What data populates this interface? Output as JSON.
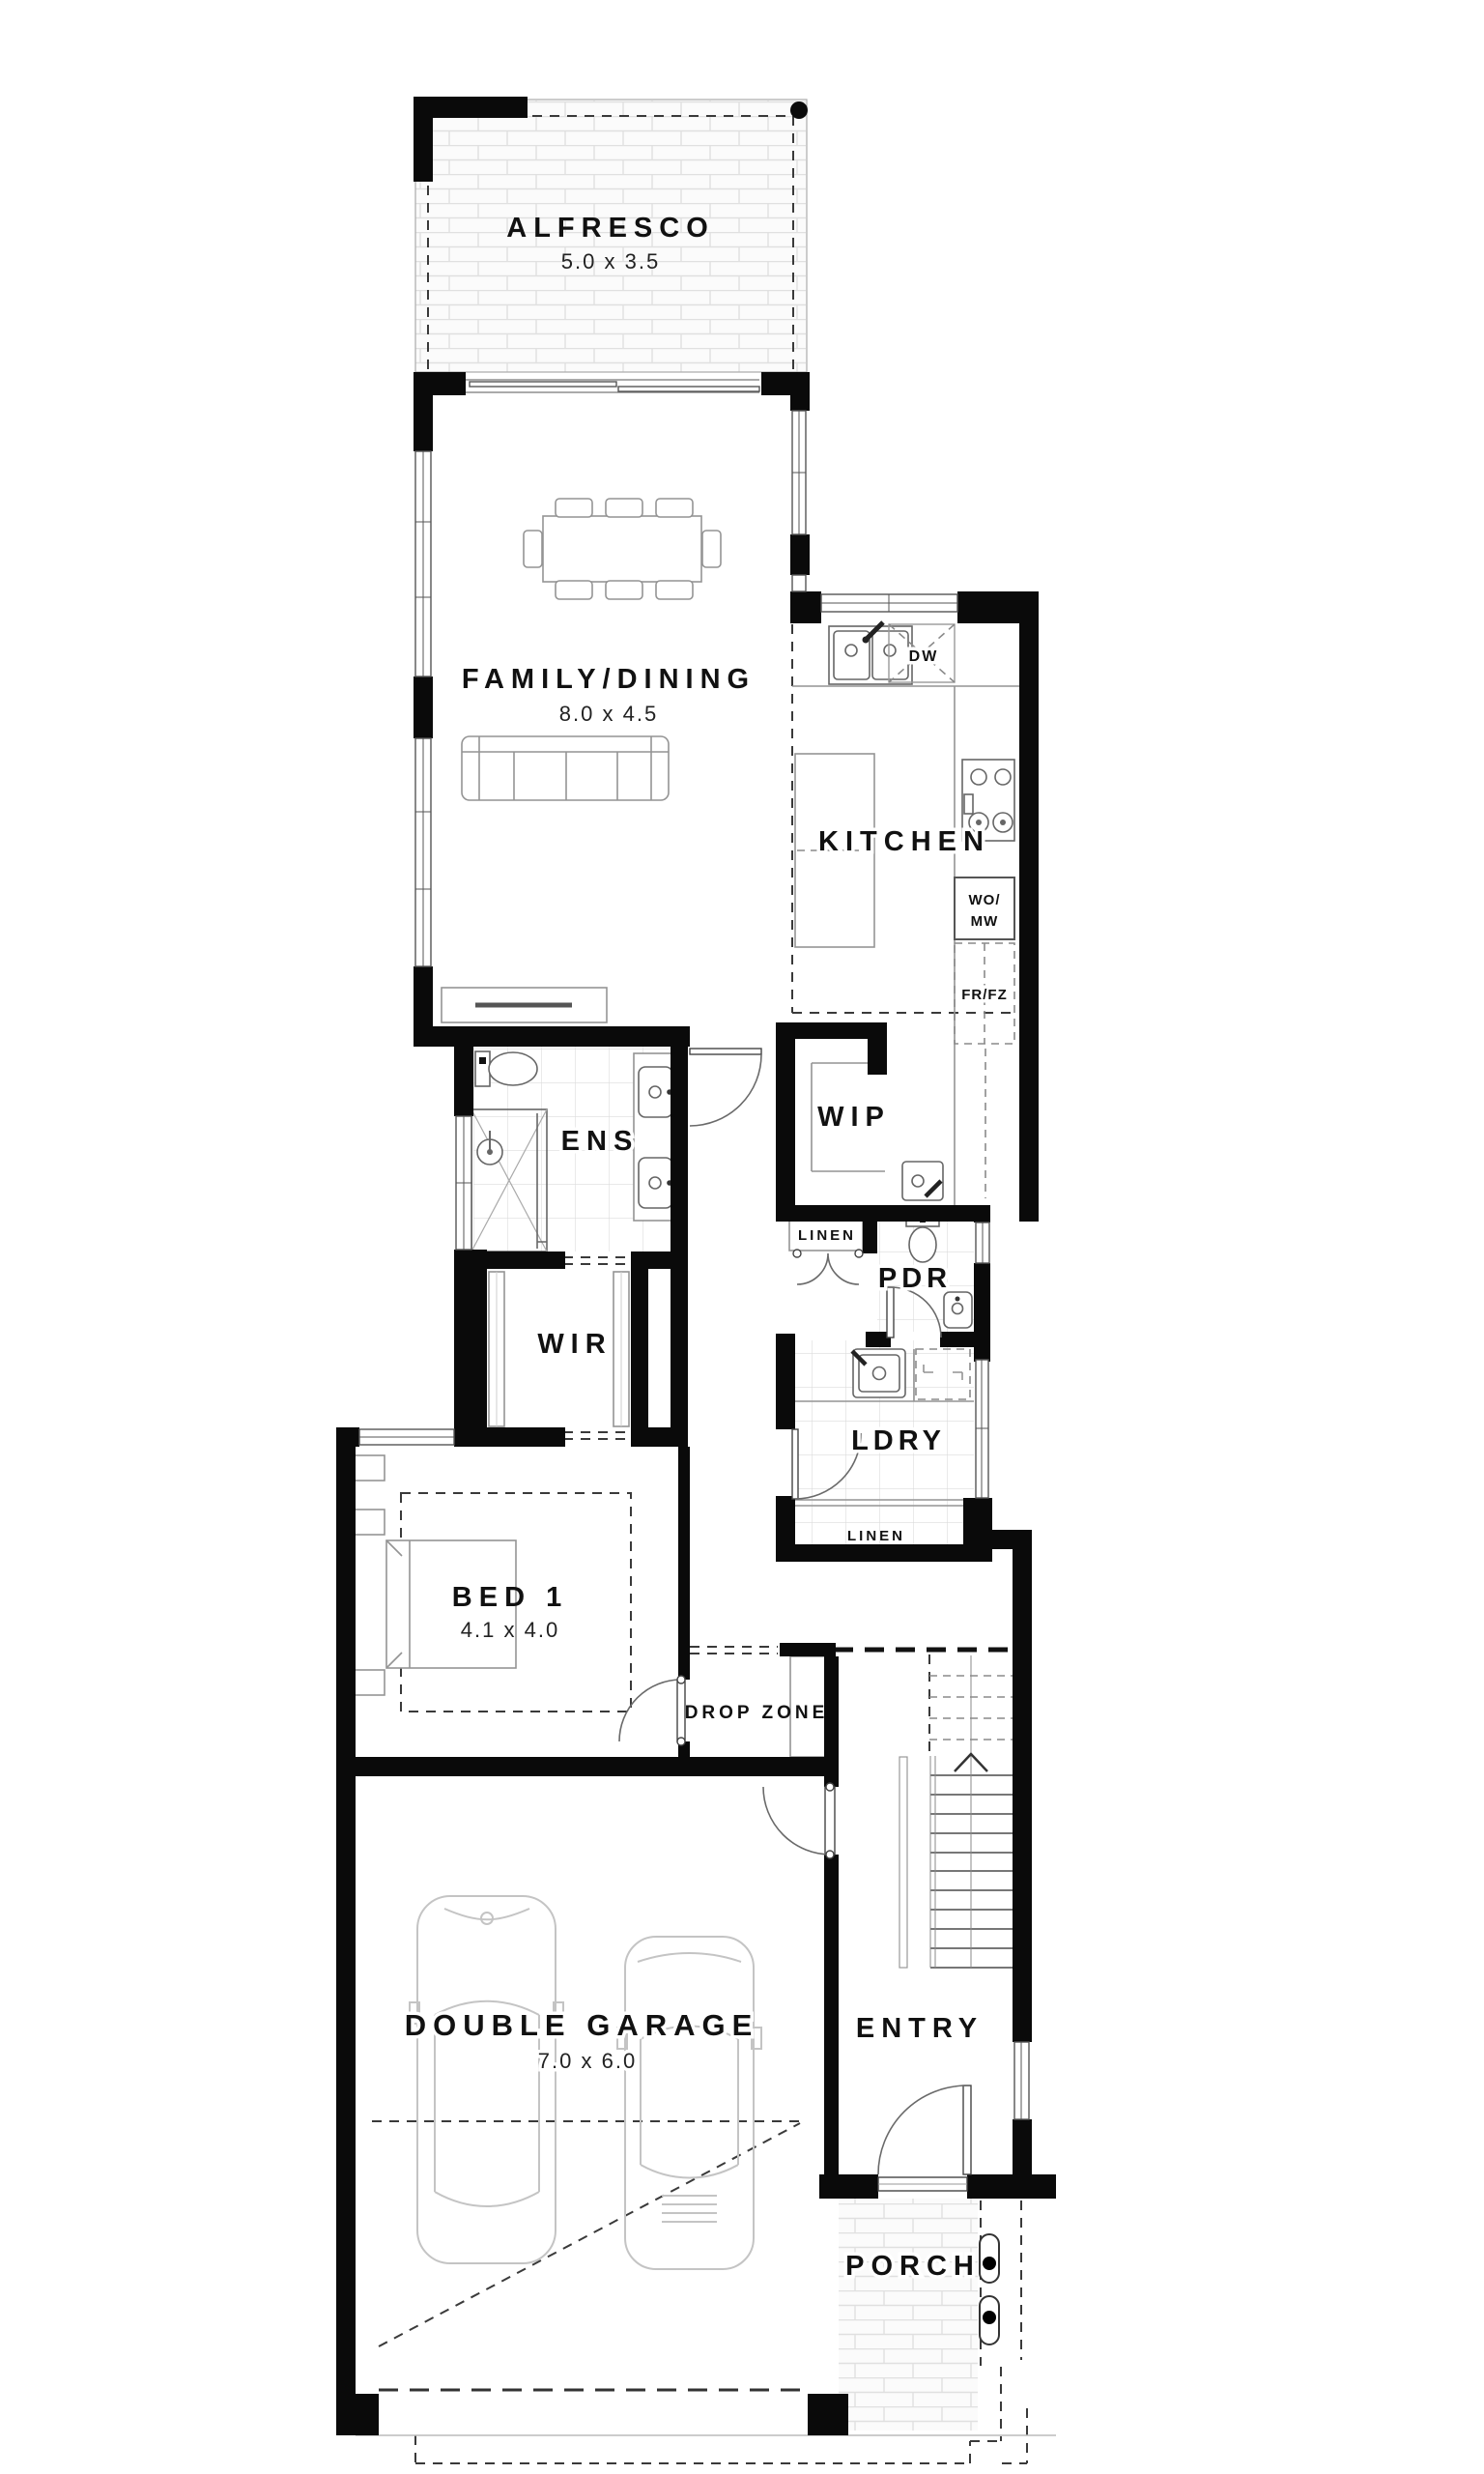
{
  "plan_title": "Single storey home ground floor plan",
  "rooms": {
    "alfresco": {
      "label": "ALFRESCO",
      "dims": "5.0 x 3.5"
    },
    "family_dining": {
      "label": "FAMILY/DINING",
      "dims": "8.0 x 4.5"
    },
    "kitchen": {
      "label": "KITCHEN"
    },
    "wip": {
      "label": "WIP"
    },
    "ens": {
      "label": "ENS"
    },
    "wir": {
      "label": "WIR"
    },
    "linen_upper": {
      "label": "LINEN"
    },
    "pdr": {
      "label": "PDR"
    },
    "ldry": {
      "label": "LDRY"
    },
    "linen_lower": {
      "label": "LINEN"
    },
    "bed1": {
      "label": "BED 1",
      "dims": "4.1 x 4.0"
    },
    "drop_zone": {
      "label": "DROP ZONE"
    },
    "double_garage": {
      "label": "DOUBLE GARAGE",
      "dims": "7.0 x 6.0"
    },
    "entry": {
      "label": "ENTRY"
    },
    "porch": {
      "label": "PORCH"
    }
  },
  "appliances": {
    "dishwasher": "DW",
    "wall_oven_line1": "WO/",
    "wall_oven_line2": "MW",
    "fridge_freezer": "FR/FZ"
  },
  "colors": {
    "wall": "#0a0a0a",
    "furniture_line": "#949494",
    "dashed_line": "#3a3a3a",
    "tile_line": "#dcdcdc",
    "brick_line": "#e0e0e0",
    "text": "#111111",
    "background": "#ffffff"
  }
}
